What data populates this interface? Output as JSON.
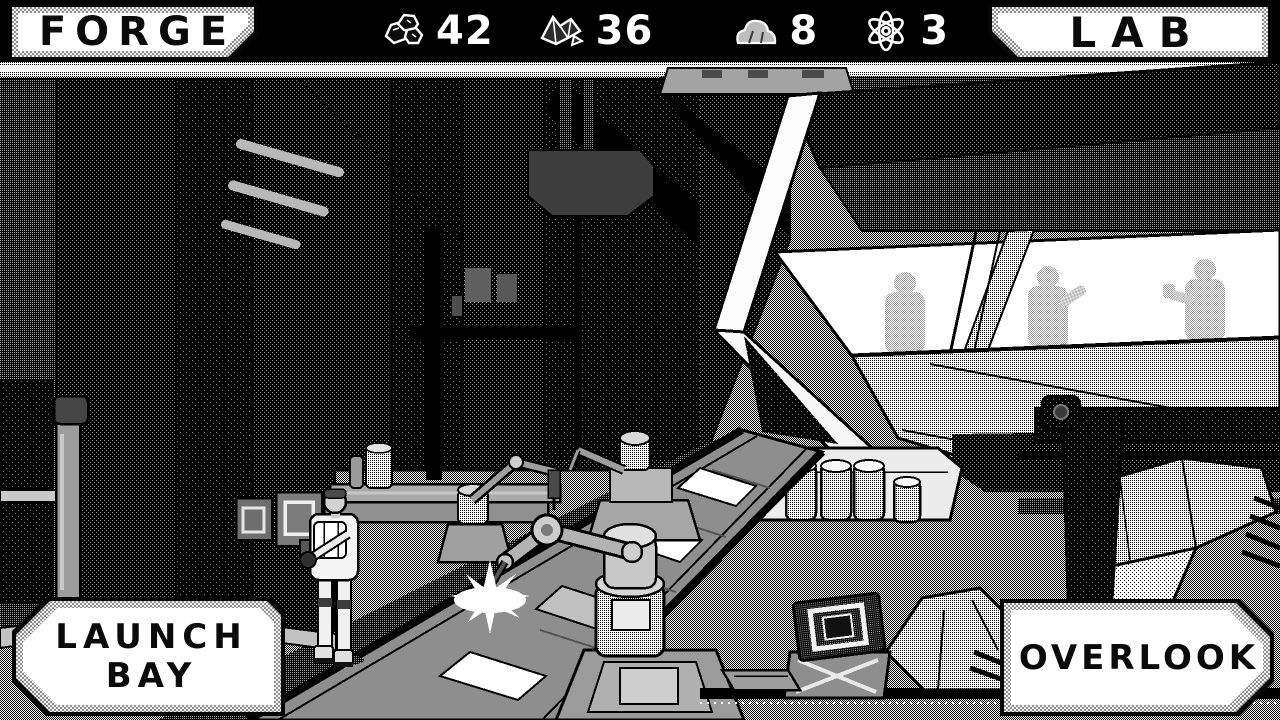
{
  "header": {
    "forge_label": "FORGE",
    "lab_label": "LAB",
    "resources": [
      {
        "icon": "ore-icon",
        "name": "ore",
        "value": "42"
      },
      {
        "icon": "crystal-icon",
        "name": "crystal",
        "value": "36"
      },
      {
        "icon": "stone-icon",
        "name": "stone",
        "value": "8"
      },
      {
        "icon": "atom-icon",
        "name": "atom",
        "value": "3"
      }
    ]
  },
  "footer": {
    "launch_bay_line1": "LAUNCH",
    "launch_bay_line2": "BAY",
    "overlook_label": "OVERLOOK"
  },
  "scene": {
    "room": "forge-assembly-floor",
    "window_figures": 3,
    "canisters": 4,
    "robot_arms": 3,
    "crate_stacks": 2,
    "characters": 1
  },
  "palette": {
    "ink": "#000000",
    "paper": "#ffffff",
    "floor_gray": "#9c9c9c",
    "machine_gray": "#b3b3b3"
  }
}
